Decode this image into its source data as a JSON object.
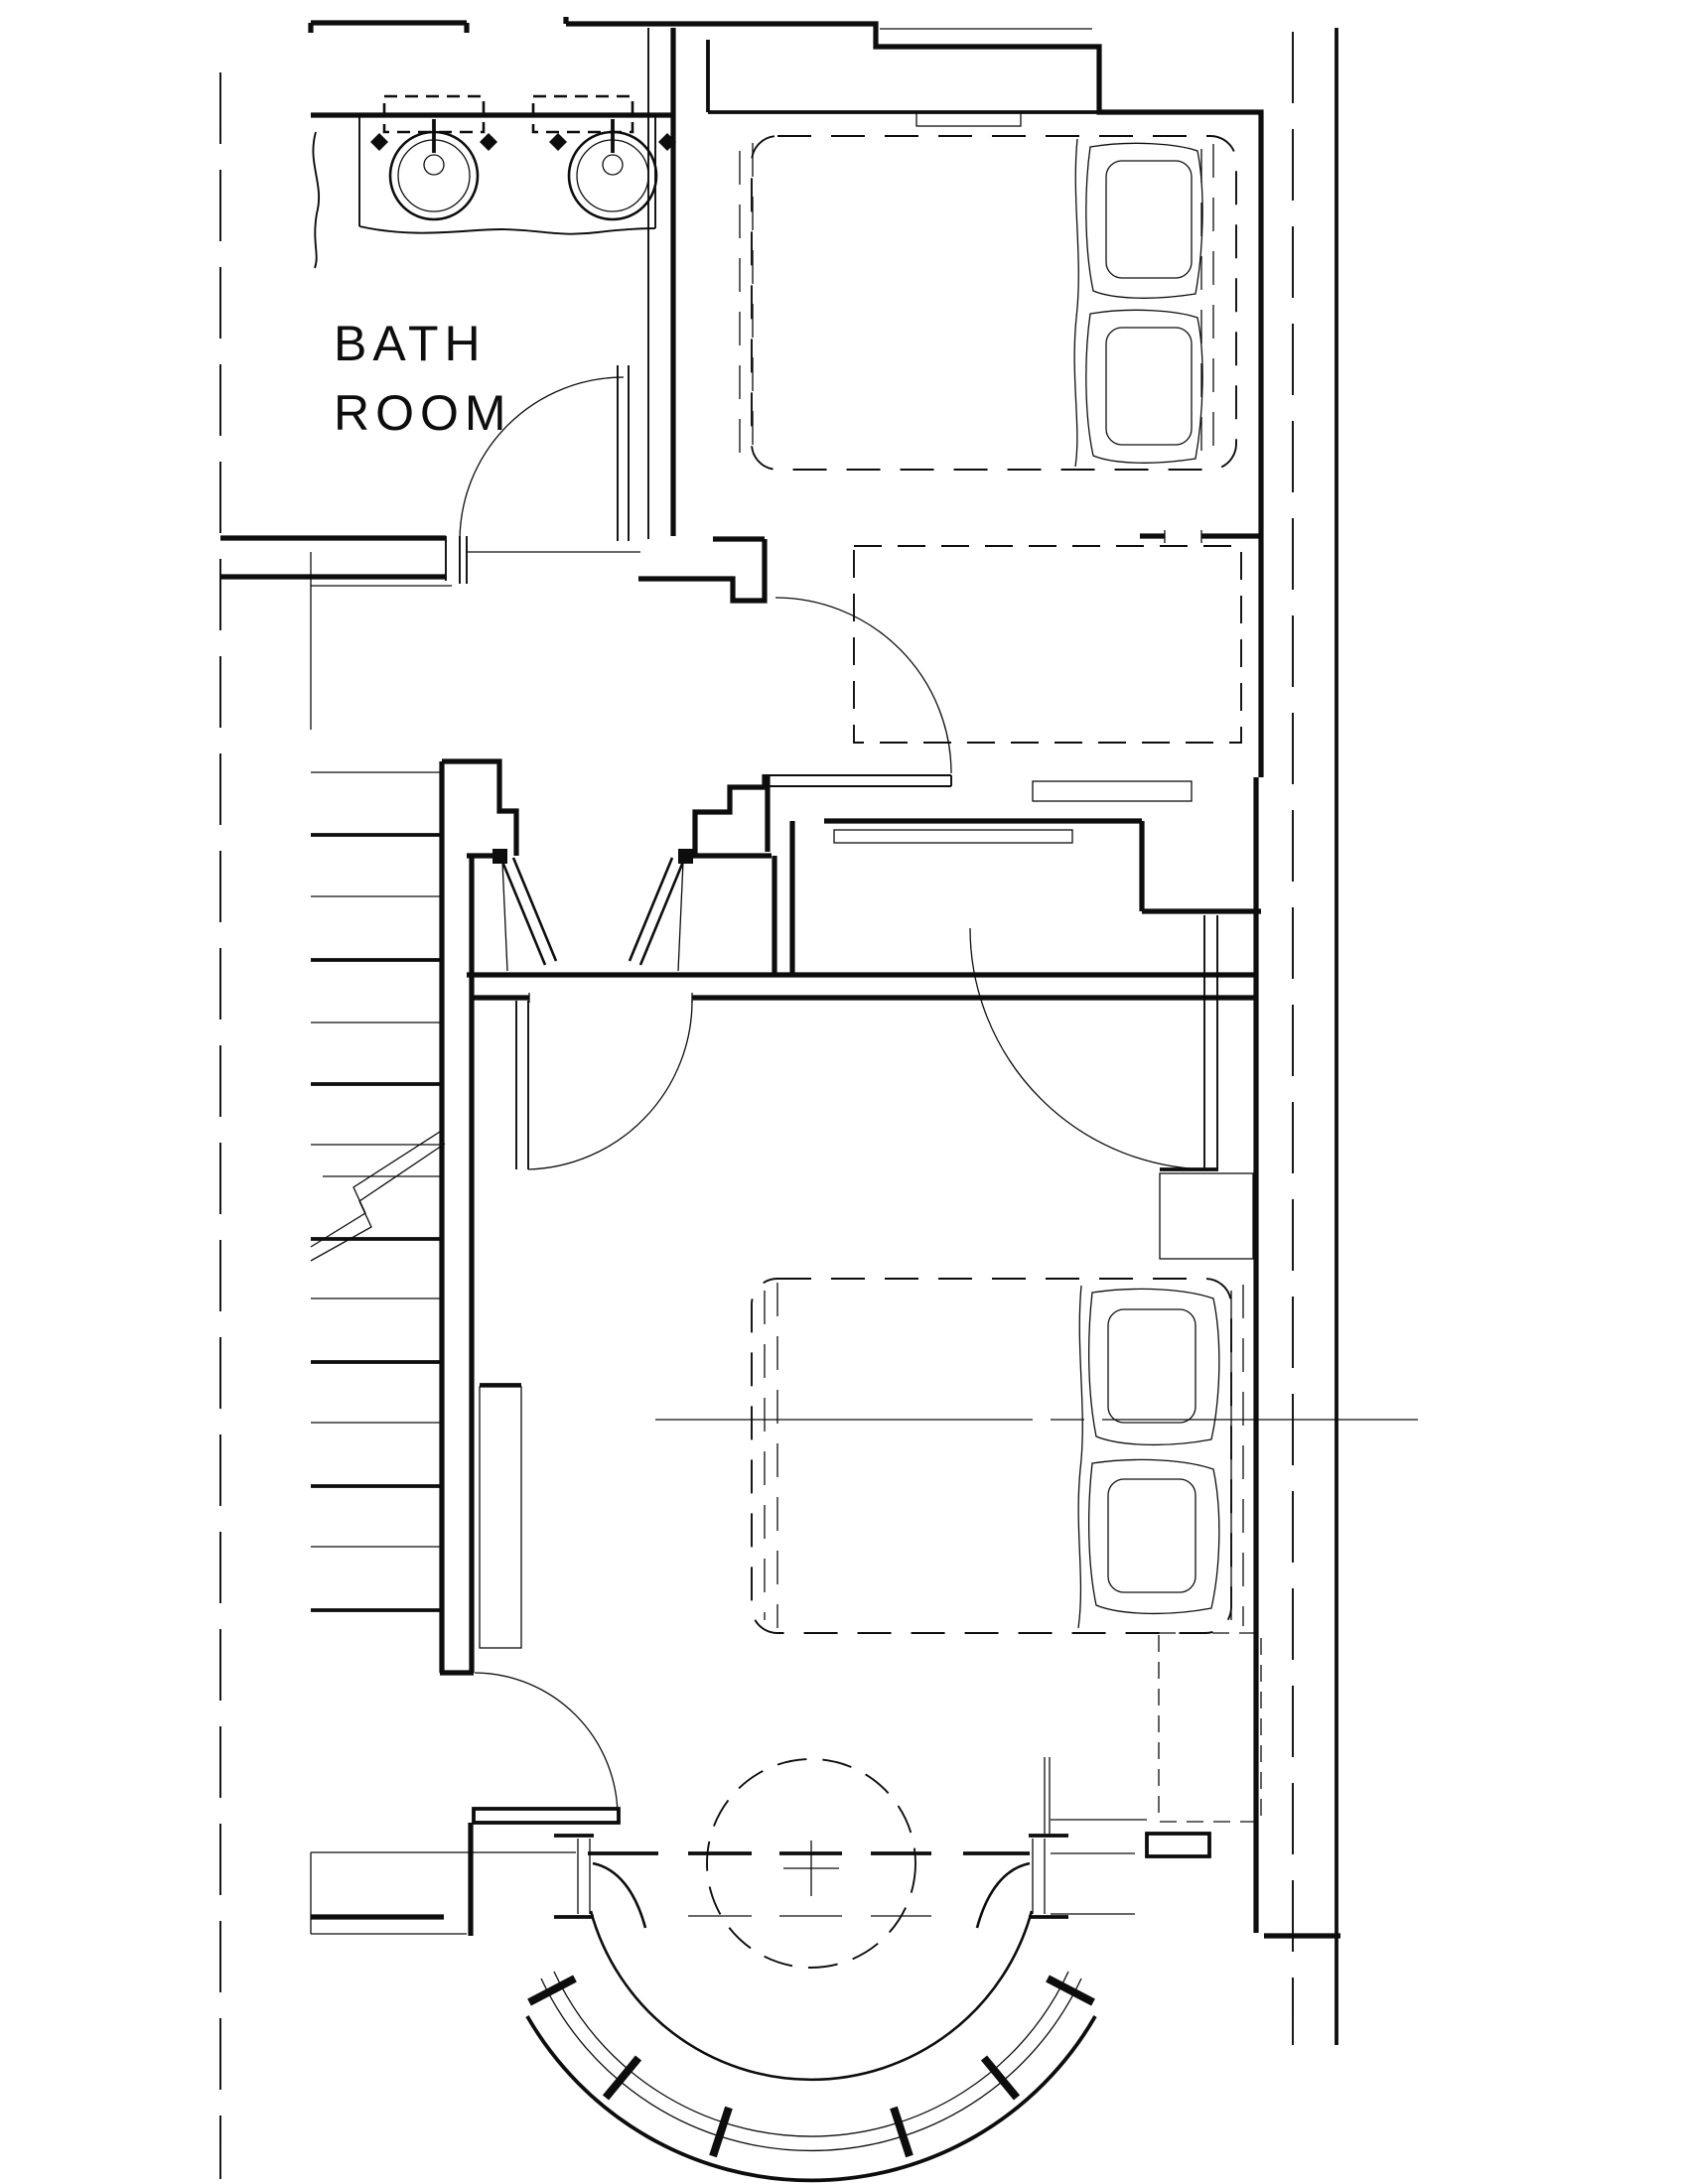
{
  "drawing": {
    "type": "architectural-floor-plan",
    "bg_color": "#ffffff",
    "ink_color": "#0d0d0d",
    "title": "Bathroom and bedrooms floor plan"
  },
  "labels": {
    "bathroom_line1": "BATH",
    "bathroom_line2": "ROOM"
  },
  "rooms": [
    {
      "name": "bathroom",
      "label": "BATH ROOM"
    },
    {
      "name": "bedroom-upper",
      "label": ""
    },
    {
      "name": "dressing-closet-area",
      "label": ""
    },
    {
      "name": "stair-hall",
      "label": ""
    },
    {
      "name": "bedroom-main",
      "label": ""
    },
    {
      "name": "bay-window",
      "label": ""
    }
  ],
  "fixtures": [
    "double-vanity",
    "sink-left",
    "sink-right",
    "faucet-left",
    "faucet-right",
    "mirror-left",
    "mirror-right",
    "bed-upper",
    "bed-main",
    "pillows",
    "nightstand-upper",
    "nightstand-lower",
    "dresser",
    "wardrobe-doors",
    "stairs",
    "stair-break-line",
    "bay-window-glazing",
    "ceiling-circle",
    "door-bathroom",
    "door-landing",
    "door-bedroom-main",
    "door-dressing",
    "door-southwest"
  ]
}
